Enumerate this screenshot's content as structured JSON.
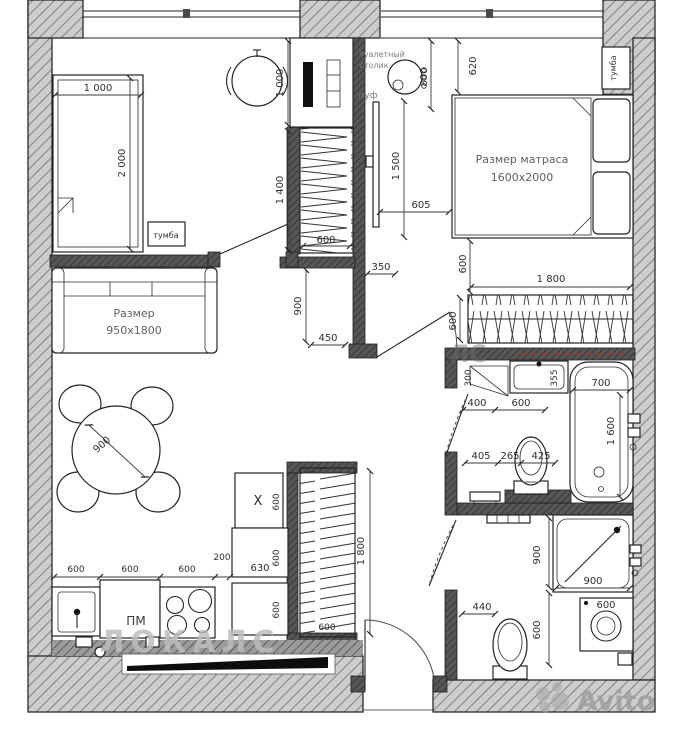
{
  "watermarks": {
    "site_large": "ЛОКАЛС",
    "site_partial": "ЛС",
    "brand": "Avito"
  },
  "living": {
    "bed_w": "1 000",
    "bed_l": "2 000",
    "nightstand": "тумба",
    "desk_d": "1 000",
    "wr_top_h": "1 400",
    "wr_top_w": "600",
    "d350": "350",
    "d900": "900",
    "d450": "450",
    "sofa1": "Размер",
    "sofa2": "950x1800",
    "table_d": "900",
    "k1": "600",
    "k2": "600",
    "k3": "600",
    "k4": "200",
    "pm": "ПМ",
    "x_mark": "Х",
    "xd": "600",
    "c630": "630",
    "c600a": "600",
    "c600b": "600",
    "wr_bot_h": "1 800",
    "wr_bot_w": "600"
  },
  "bedroom": {
    "lbl_table1": "туалетный",
    "lbl_table2": "столик",
    "lbl_pouf": "пуф",
    "d620": "620",
    "d800": "800",
    "d1500": "1 500",
    "d605": "605",
    "bed1": "Размер матраса",
    "bed2": "1600x2000",
    "nightstand": "тумба"
  },
  "hall": {
    "gap600": "600",
    "wr_w": "1 800",
    "wr_d": "600"
  },
  "bath": {
    "d300": "300",
    "sink355": "355",
    "bath_w": "700",
    "bath_l": "1 600",
    "d400": "400",
    "d600": "600",
    "d405": "405",
    "d265": "265",
    "d425": "425"
  },
  "shower": {
    "h900": "900",
    "w900": "900",
    "door440": "440",
    "d600": "600",
    "wm600": "600"
  }
}
